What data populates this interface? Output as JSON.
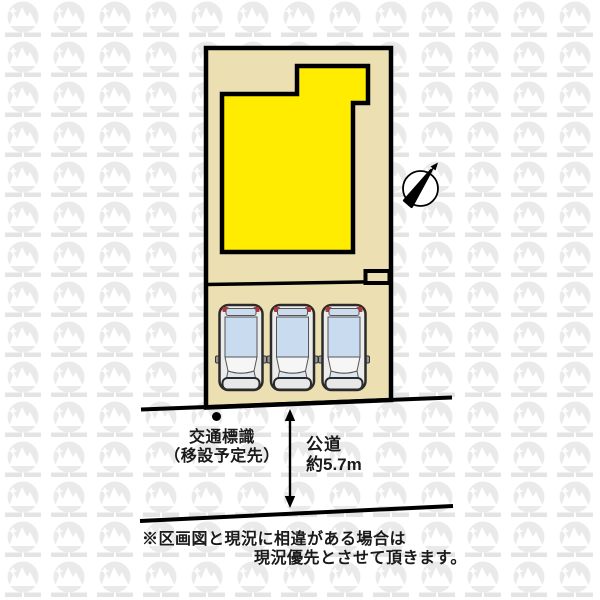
{
  "diagram": {
    "type": "real-estate-plot-layout",
    "labels": {
      "traffic_sign_line1": "交通標識",
      "traffic_sign_line2": "（移設予定先）",
      "road_name": "公道",
      "road_width": "約5.7m",
      "disclaimer_line1": "※区画図と現況に相違がある場合は",
      "disclaimer_line2": "現況優先とさせて頂きます。"
    },
    "parking": {
      "spaces": 3
    },
    "icons": {
      "compass": "compass-north-icon",
      "traffic_sign_marker": "dot-marker-icon",
      "road_width_arrow": "double-headed-vertical-arrow-icon",
      "watermark": "mountain-logo-watermark-icon"
    },
    "colors": {
      "plot_fill": "#ece0b2",
      "building_fill": "#ffec00",
      "outline": "#000000",
      "car_roof_glass": "#c9dbee",
      "car_windshield": "#f6f6f6",
      "car_taillight": "#bb3333",
      "watermark_gray": "#eaeaea"
    }
  }
}
